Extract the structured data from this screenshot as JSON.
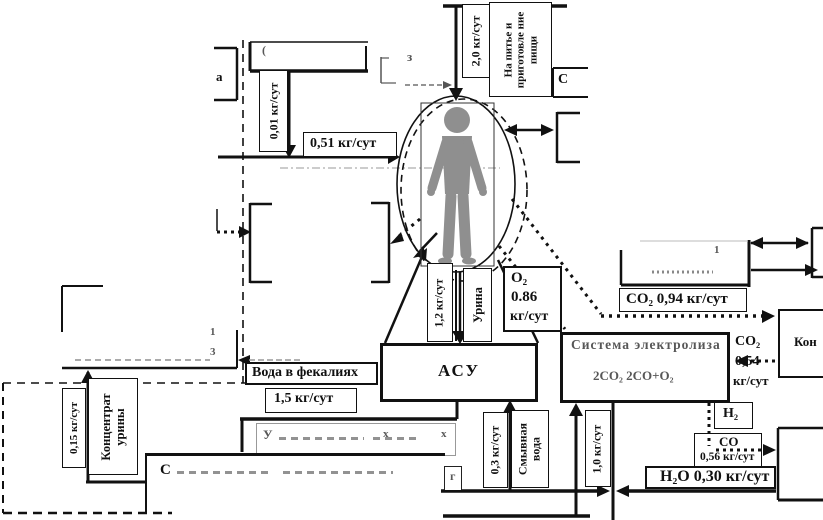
{
  "flows": {
    "f001": "0,01 кг/сут",
    "f051": "0,51 кг/сут",
    "f20": "2,0 кг/сут",
    "f12": "1,2 кг/сут",
    "f15": "1,5 кг/сут",
    "f03": "0,3 кг/сут",
    "f10": "1,0 кг/сут",
    "f015": "0,15 кг/сут"
  },
  "nodes": {
    "drink": "На питье и приготовле ние пищи",
    "asu": "АСУ",
    "urine": "Урина",
    "urine_concentrate": "Концентрат урины",
    "flush_water": "Смывная вода",
    "feces_water": "Вода в фекалиях",
    "electrolysis_title": "Система электролиза",
    "electrolysis_formula": "2СО₂  2СО+О₂",
    "kon_partial": "Кон"
  },
  "gases": {
    "o2_name": "О₂",
    "o2_value": "0.86",
    "o2_unit": "кг/сут",
    "co2_out": "СО₂  0,94 кг/сут",
    "co2_in_name": "СО₂",
    "co2_in_value": "0,54",
    "co2_in_unit": "кг/сут",
    "h2": "Н₂",
    "co_name": "СО",
    "co_value": "0,56 кг/сут",
    "h2o": "Н₂О  0,30 кг/сут"
  },
  "fragments": {
    "a": "а",
    "paren": "(",
    "z": "з",
    "c_top": "С",
    "g": "г",
    "u_initial": "У",
    "x1": "х",
    "x2": "х",
    "s_initial": "С",
    "n1": "1",
    "n3": "3",
    "na_one": "1"
  }
}
